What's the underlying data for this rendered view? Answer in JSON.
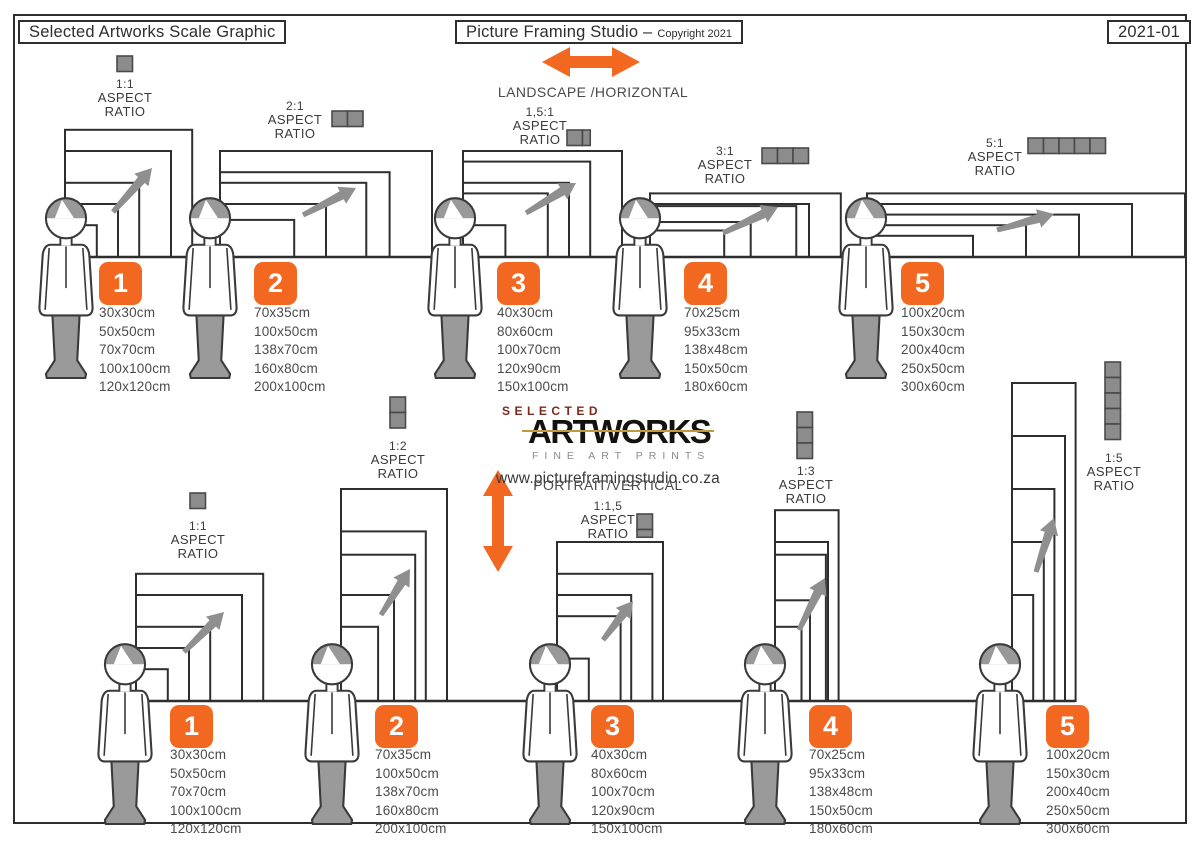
{
  "header": {
    "title": "Selected Artworks Scale Graphic",
    "studio": "Picture Framing Studio –",
    "copyright": "Copyright 2021",
    "edition": "2021-01"
  },
  "branding": {
    "selected": "SELECTED",
    "artworks": "ARTWORKS",
    "tagline": "FINE ART PRINTS",
    "website": "www.pictureframingstudio.co.za"
  },
  "sections": {
    "landscape": "LANDSCAPE /HORIZONTAL",
    "portrait": "PORTRAIT/VERTICAL"
  },
  "aspect_label": {
    "line1": "ASPECT",
    "line2": "RATIO"
  },
  "colors": {
    "accent": "#f26821",
    "swatch_gray": "#8c8c8c",
    "arrow_gray": "#8f8f8f",
    "ink": "#2e2e2e",
    "logo_red": "#7a2a1c",
    "logo_gold": "#c19a3e"
  },
  "groups": [
    {
      "number": "1",
      "landscape_ratio": "1:1",
      "portrait_ratio": "1:1",
      "ratio_units": 1,
      "sizes": [
        "30x30cm",
        "50x50cm",
        "70x70cm",
        "100x100cm",
        "120x120cm"
      ]
    },
    {
      "number": "2",
      "landscape_ratio": "2:1",
      "portrait_ratio": "1:2",
      "ratio_units": 2,
      "sizes": [
        "70x35cm",
        "100x50cm",
        "138x70cm",
        "160x80cm",
        "200x100cm"
      ]
    },
    {
      "number": "3",
      "landscape_ratio": "1,5:1",
      "portrait_ratio": "1:1,5",
      "ratio_units": 1.5,
      "sizes": [
        "40x30cm",
        "80x60cm",
        "100x70cm",
        "120x90cm",
        "150x100cm"
      ]
    },
    {
      "number": "4",
      "landscape_ratio": "3:1",
      "portrait_ratio": "1:3",
      "ratio_units": 3,
      "sizes": [
        "70x25cm",
        "95x33cm",
        "138x48cm",
        "150x50cm",
        "180x60cm"
      ]
    },
    {
      "number": "5",
      "landscape_ratio": "5:1",
      "portrait_ratio": "1:5",
      "ratio_units": 5,
      "sizes": [
        "100x20cm",
        "150x30cm",
        "200x40cm",
        "250x50cm",
        "300x60cm"
      ]
    }
  ]
}
